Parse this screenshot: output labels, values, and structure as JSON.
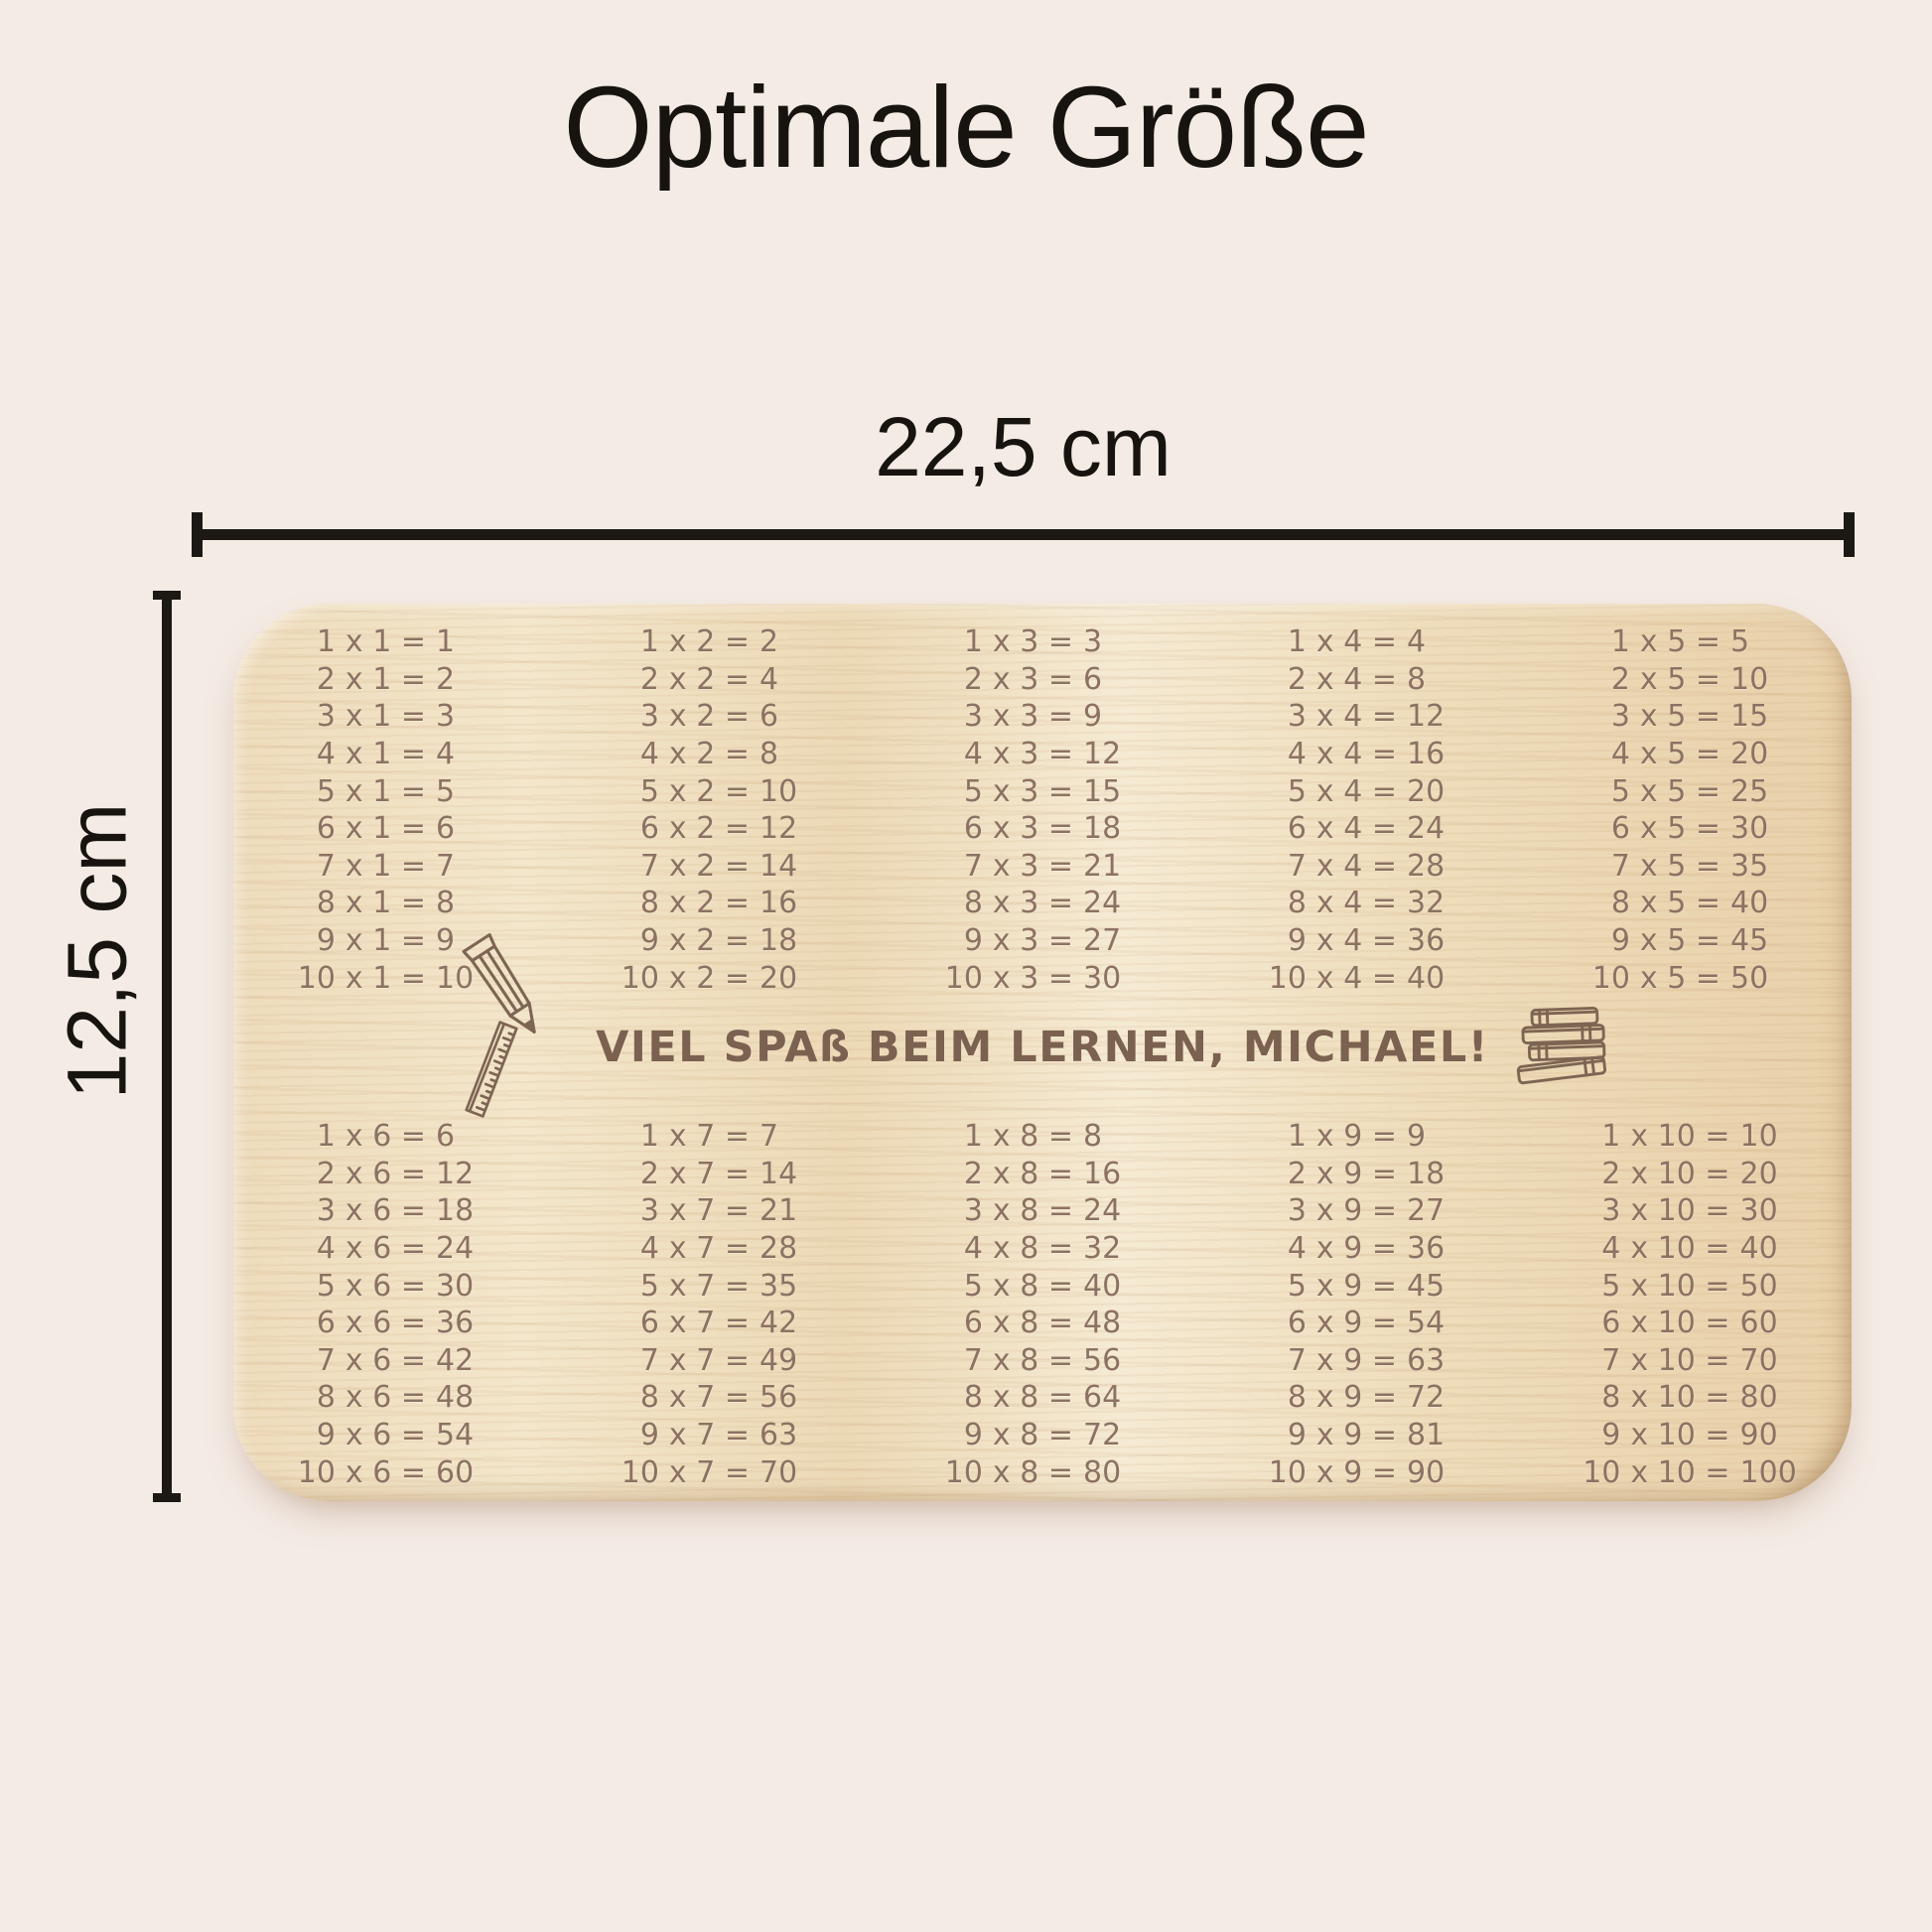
{
  "title": "Optimale Größe",
  "dimensions": {
    "width_label": "22,5 cm",
    "height_label": "12,5 cm"
  },
  "board": {
    "message": "VIEL SPAß BEIM LERNEN, MICHAEL!",
    "operator": "x",
    "equals": "=",
    "multiplicands": [
      1,
      2,
      3,
      4,
      5,
      6,
      7,
      8,
      9,
      10
    ],
    "top_tables": [
      {
        "factor": 1,
        "products": [
          1,
          2,
          3,
          4,
          5,
          6,
          7,
          8,
          9,
          10
        ]
      },
      {
        "factor": 2,
        "products": [
          2,
          4,
          6,
          8,
          10,
          12,
          14,
          16,
          18,
          20
        ]
      },
      {
        "factor": 3,
        "products": [
          3,
          6,
          9,
          12,
          15,
          18,
          21,
          24,
          27,
          30
        ]
      },
      {
        "factor": 4,
        "products": [
          4,
          8,
          12,
          16,
          20,
          24,
          28,
          32,
          36,
          40
        ]
      },
      {
        "factor": 5,
        "products": [
          5,
          10,
          15,
          20,
          25,
          30,
          35,
          40,
          45,
          50
        ]
      }
    ],
    "bottom_tables": [
      {
        "factor": 6,
        "products": [
          6,
          12,
          18,
          24,
          30,
          36,
          42,
          48,
          54,
          60
        ]
      },
      {
        "factor": 7,
        "products": [
          7,
          14,
          21,
          28,
          35,
          42,
          49,
          56,
          63,
          70
        ]
      },
      {
        "factor": 8,
        "products": [
          8,
          16,
          24,
          32,
          40,
          48,
          56,
          64,
          72,
          80
        ]
      },
      {
        "factor": 9,
        "products": [
          9,
          18,
          27,
          36,
          45,
          54,
          63,
          72,
          81,
          90
        ]
      },
      {
        "factor": 10,
        "products": [
          10,
          20,
          30,
          40,
          50,
          60,
          70,
          80,
          90,
          100
        ]
      }
    ],
    "icons": [
      "pencil-icon",
      "ruler-icon",
      "books-icon"
    ]
  },
  "colors": {
    "page_background": "#f4ebe5",
    "board_wood": "#eedcbc",
    "engraving": "#8c7262",
    "message_engraving": "#7b6150",
    "dimension_lines": "#1c1915"
  }
}
